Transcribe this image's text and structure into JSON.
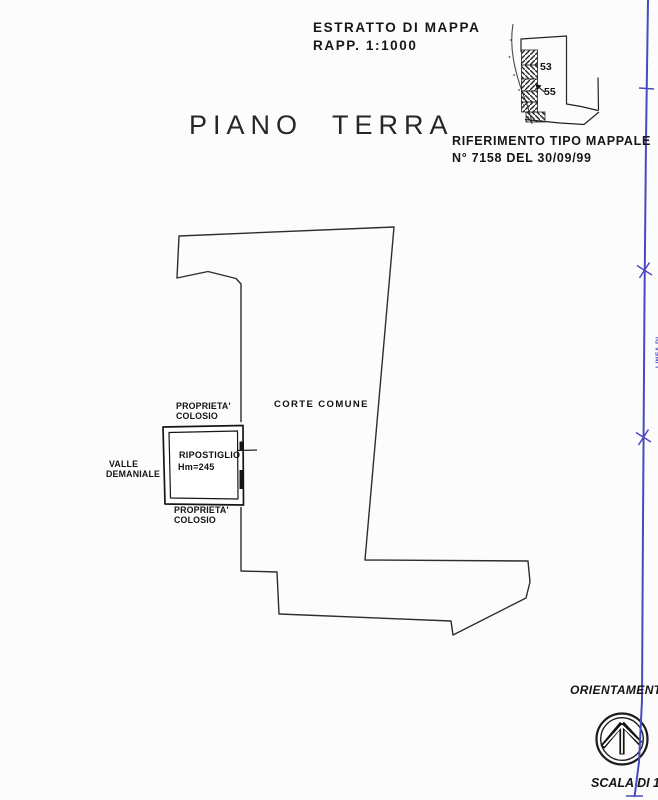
{
  "map_extract_header": {
    "line1": "ESTRATTO DI MAPPA",
    "line2": "RAPP. 1:1000"
  },
  "map_extract": {
    "label_53": "53",
    "label_55": "55"
  },
  "reference": {
    "line1": "RIFERIMENTO TIPO MAPPALE",
    "line2": "N° 7158 DEL 30/09/99"
  },
  "title": "PIANO TERRA",
  "plan": {
    "corte_comune": "CORTE COMUNE",
    "proprieta_top_line1": "PROPRIETA'",
    "proprieta_top_line2": "COLOSIO",
    "ripostiglio_line1": "RIPOSTIGLIO",
    "ripostiglio_line2": "Hm=245",
    "proprieta_bottom_line1": "PROPRIETA'",
    "proprieta_bottom_line2": "COLOSIO",
    "valle_line1": "VALLE",
    "valle_line2": "DEMANIALE"
  },
  "orientation": {
    "label": "ORIENTAMENTO"
  },
  "scale": {
    "prefix": "SCALA DI 1:",
    "value": "2"
  },
  "fold_line": {
    "vertical_label": "LINEA DI"
  },
  "colors": {
    "ink": "#1f1f1f",
    "accent_blue": "#4a4ac0",
    "paper": "#fcfcfc"
  }
}
